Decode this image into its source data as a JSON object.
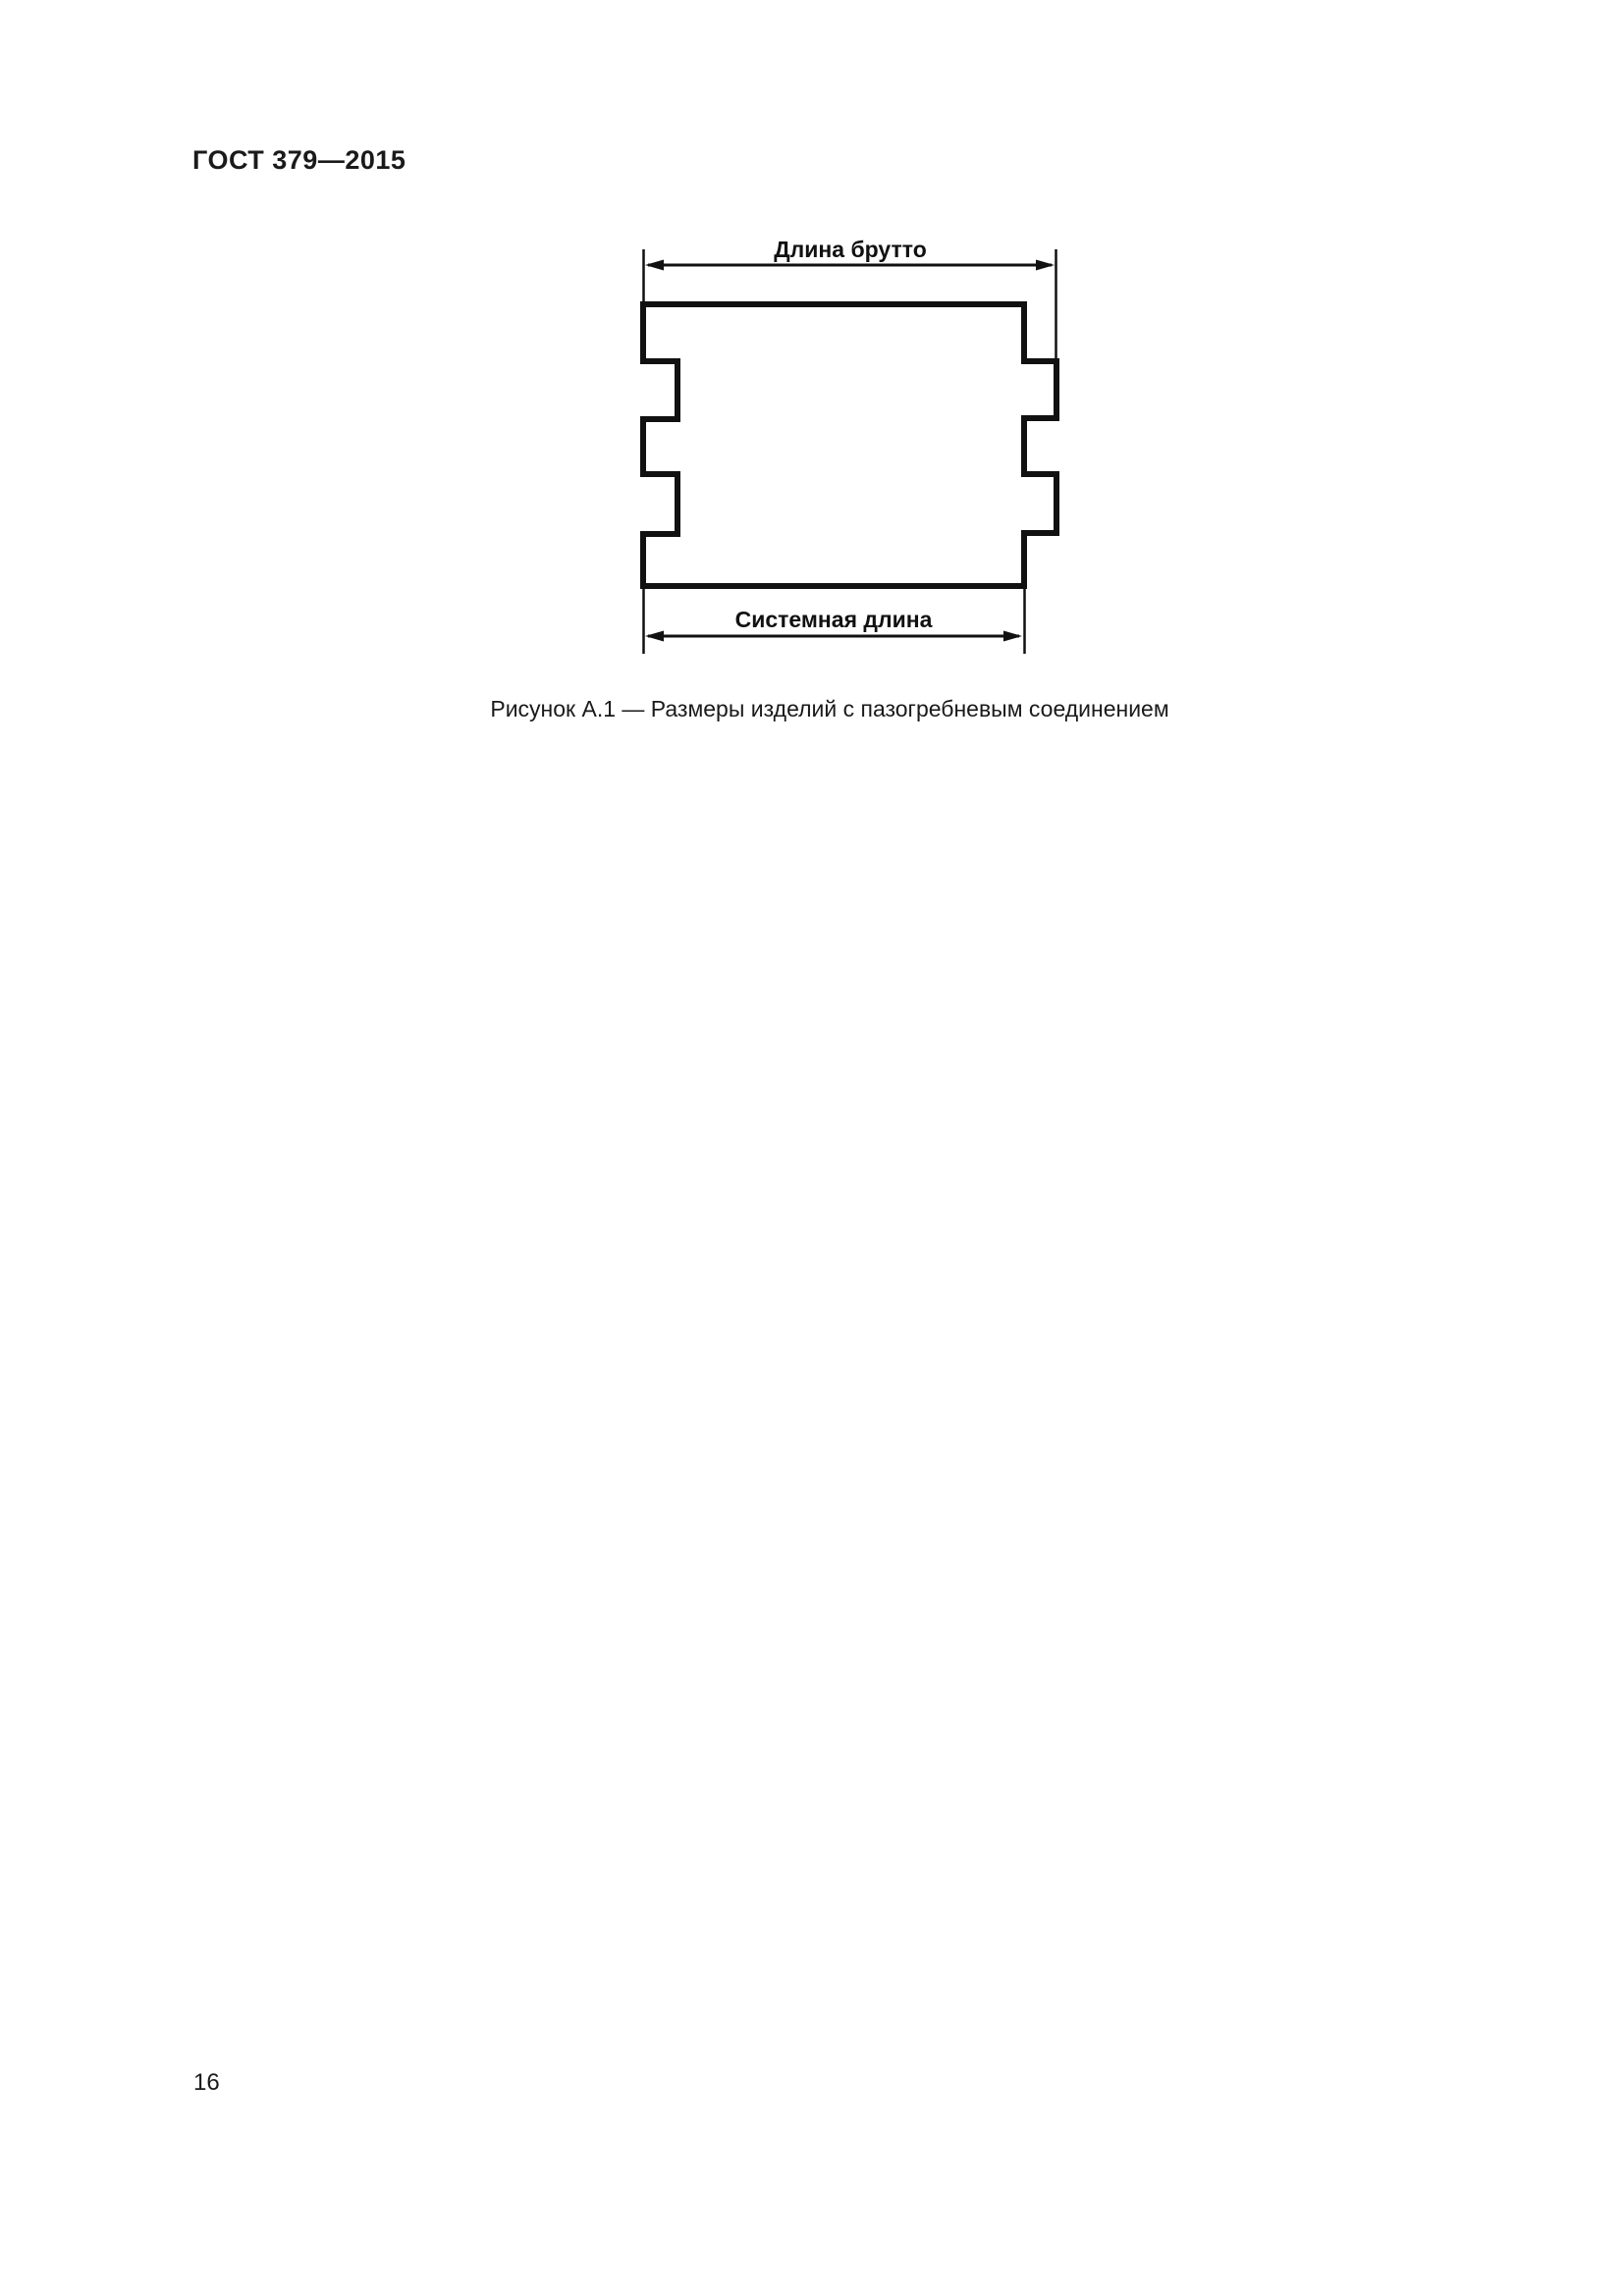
{
  "page": {
    "header": "ГОСТ 379—2015",
    "page_number": "16"
  },
  "figure": {
    "caption": "Рисунок А.1 — Размеры изделий с пазогребневым соединением",
    "dimension_top_label": "Длина брутто",
    "dimension_bottom_label": "Системная длина",
    "ink_color": "#111111",
    "background_color": "#ffffff"
  }
}
